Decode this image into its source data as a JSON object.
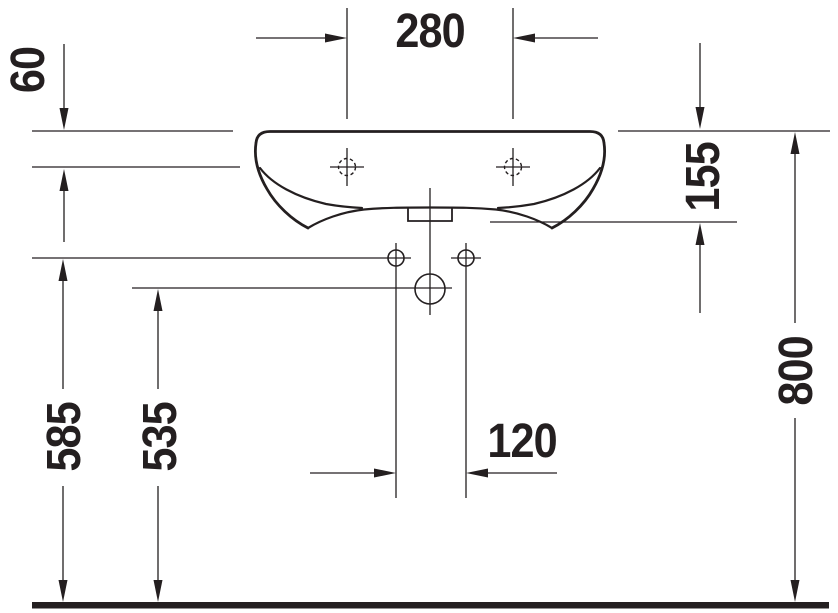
{
  "drawing": {
    "ink_color": "#241f20",
    "background_color": "#ffffff",
    "dimensions": {
      "tap_spacing": "280",
      "tap_drop": "60",
      "front_height": "155",
      "rim_height": "800",
      "fixing_height": "585",
      "drain_height": "535",
      "fixing_spacing": "120"
    }
  }
}
